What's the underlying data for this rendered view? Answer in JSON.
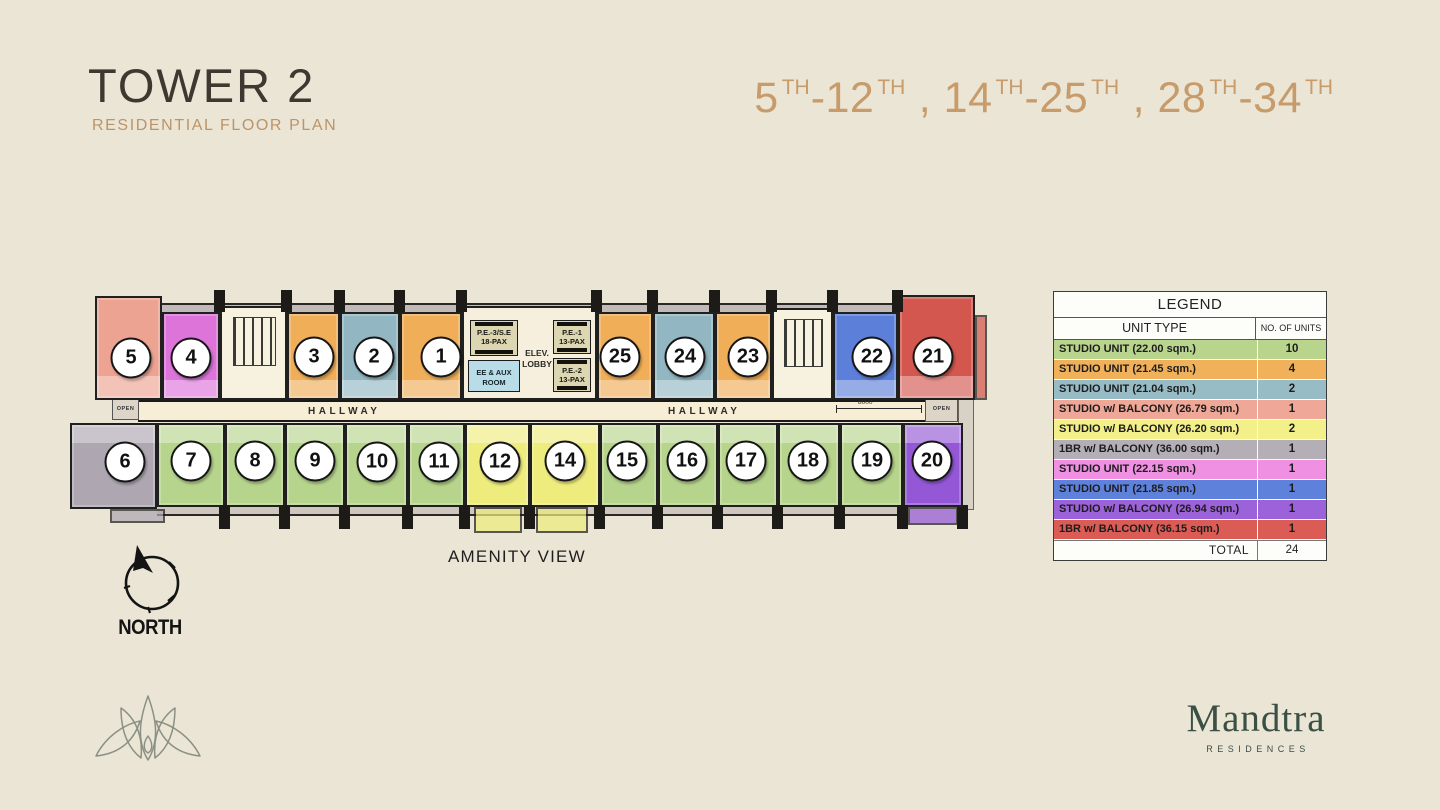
{
  "header": {
    "title": "TOWER 2",
    "subtitle": "RESIDENTIAL FLOOR PLAN",
    "floors": [
      {
        "base": "5",
        "sup": "TH"
      },
      {
        "base": "-12",
        "sup": "TH"
      },
      {
        "base": " , 14",
        "sup": "TH"
      },
      {
        "base": "-25",
        "sup": "TH"
      },
      {
        "base": " , 28",
        "sup": "TH"
      },
      {
        "base": "-34",
        "sup": "TH"
      }
    ]
  },
  "plan": {
    "hallway_label": "HALLWAY",
    "amenity_label": "AMENITY VIEW",
    "north_label": "NORTH",
    "open_label": "OPEN",
    "dimension": "8000",
    "core": {
      "pe3_l1": "P.E.-3/S.E",
      "pe3_l2": "18-PAX",
      "pe1_l1": "P.E.-1",
      "pe1_l2": "13-PAX",
      "pe2_l1": "P.E.-2",
      "pe2_l2": "13-PAX",
      "ee_l1": "EE & AUX",
      "ee_l2": "ROOM",
      "lobby_l1": "ELEV.",
      "lobby_l2": "LOBBY"
    },
    "units": [
      {
        "no": "5",
        "row": "top",
        "x": 95,
        "y": 296,
        "w": 67,
        "h": 104,
        "cx": 131,
        "cy": 358,
        "color": "#eda392"
      },
      {
        "no": "4",
        "row": "top",
        "x": 162,
        "y": 312,
        "w": 58,
        "h": 88,
        "cx": 191,
        "cy": 358,
        "color": "#dd74da"
      },
      {
        "no": "3",
        "row": "top",
        "x": 287,
        "y": 312,
        "w": 53,
        "h": 88,
        "cx": 314,
        "cy": 357,
        "color": "#f0ae58"
      },
      {
        "no": "2",
        "row": "top",
        "x": 340,
        "y": 312,
        "w": 60,
        "h": 88,
        "cx": 374,
        "cy": 357,
        "color": "#92b7c2"
      },
      {
        "no": "1",
        "row": "top",
        "x": 400,
        "y": 312,
        "w": 62,
        "h": 88,
        "cx": 441,
        "cy": 357,
        "color": "#f0ae58"
      },
      {
        "no": "25",
        "row": "top",
        "x": 597,
        "y": 312,
        "w": 56,
        "h": 88,
        "cx": 620,
        "cy": 357,
        "color": "#f0ae58"
      },
      {
        "no": "24",
        "row": "top",
        "x": 653,
        "y": 312,
        "w": 62,
        "h": 88,
        "cx": 685,
        "cy": 357,
        "color": "#92b7c2"
      },
      {
        "no": "23",
        "row": "top",
        "x": 715,
        "y": 312,
        "w": 57,
        "h": 88,
        "cx": 748,
        "cy": 357,
        "color": "#f0ae58"
      },
      {
        "no": "22",
        "row": "top",
        "x": 833,
        "y": 312,
        "w": 65,
        "h": 88,
        "cx": 872,
        "cy": 357,
        "color": "#5c80da"
      },
      {
        "no": "21",
        "row": "top",
        "x": 898,
        "y": 295,
        "w": 77,
        "h": 105,
        "cx": 933,
        "cy": 357,
        "color": "#d4574f",
        "balcony": {
          "x": 975,
          "y": 315,
          "w": 12,
          "h": 85
        }
      },
      {
        "no": "6",
        "row": "bot",
        "x": 70,
        "y": 423,
        "w": 87,
        "h": 86,
        "cx": 125,
        "cy": 462,
        "color": "#aea7b2",
        "balcony": {
          "x": 110,
          "y": 509,
          "w": 55,
          "h": 14
        }
      },
      {
        "no": "7",
        "row": "bot",
        "x": 157,
        "y": 423,
        "w": 68,
        "h": 84,
        "cx": 191,
        "cy": 461,
        "color": "#b6d48c"
      },
      {
        "no": "8",
        "row": "bot",
        "x": 225,
        "y": 423,
        "w": 60,
        "h": 84,
        "cx": 255,
        "cy": 461,
        "color": "#b6d48c"
      },
      {
        "no": "9",
        "row": "bot",
        "x": 285,
        "y": 423,
        "w": 60,
        "h": 84,
        "cx": 315,
        "cy": 461,
        "color": "#b6d48c"
      },
      {
        "no": "10",
        "row": "bot",
        "x": 345,
        "y": 423,
        "w": 63,
        "h": 84,
        "cx": 377,
        "cy": 462,
        "color": "#b6d48c"
      },
      {
        "no": "11",
        "row": "bot",
        "x": 408,
        "y": 423,
        "w": 57,
        "h": 84,
        "cx": 439,
        "cy": 462,
        "color": "#b6d48c"
      },
      {
        "no": "12",
        "row": "bot",
        "x": 465,
        "y": 423,
        "w": 65,
        "h": 84,
        "cx": 500,
        "cy": 462,
        "color": "#efec7e",
        "balcony": {
          "x": 474,
          "y": 507,
          "w": 48,
          "h": 26
        }
      },
      {
        "no": "14",
        "row": "bot",
        "x": 530,
        "y": 423,
        "w": 70,
        "h": 84,
        "cx": 565,
        "cy": 461,
        "color": "#efec7e",
        "balcony": {
          "x": 536,
          "y": 507,
          "w": 52,
          "h": 26
        }
      },
      {
        "no": "15",
        "row": "bot",
        "x": 600,
        "y": 423,
        "w": 58,
        "h": 84,
        "cx": 627,
        "cy": 461,
        "color": "#b6d48c"
      },
      {
        "no": "16",
        "row": "bot",
        "x": 658,
        "y": 423,
        "w": 60,
        "h": 84,
        "cx": 687,
        "cy": 461,
        "color": "#b6d48c"
      },
      {
        "no": "17",
        "row": "bot",
        "x": 718,
        "y": 423,
        "w": 60,
        "h": 84,
        "cx": 746,
        "cy": 461,
        "color": "#b6d48c"
      },
      {
        "no": "18",
        "row": "bot",
        "x": 778,
        "y": 423,
        "w": 62,
        "h": 84,
        "cx": 808,
        "cy": 461,
        "color": "#b6d48c"
      },
      {
        "no": "19",
        "row": "bot",
        "x": 840,
        "y": 423,
        "w": 63,
        "h": 84,
        "cx": 872,
        "cy": 461,
        "color": "#b6d48c"
      },
      {
        "no": "20",
        "row": "bot",
        "x": 903,
        "y": 423,
        "w": 60,
        "h": 84,
        "cx": 932,
        "cy": 461,
        "color": "#9458d6",
        "balcony": {
          "x": 908,
          "y": 507,
          "w": 50,
          "h": 18
        }
      }
    ]
  },
  "legend": {
    "title": "LEGEND",
    "col1": "UNIT TYPE",
    "col2": "NO. OF UNITS",
    "rows": [
      {
        "label": "STUDIO UNIT (22.00 sqm.)",
        "count": "10",
        "color": "#b9d58d"
      },
      {
        "label": "STUDIO UNIT (21.45 sqm.)",
        "count": "4",
        "color": "#f1b15b"
      },
      {
        "label": "STUDIO UNIT (21.04 sqm.)",
        "count": "2",
        "color": "#97bcc6"
      },
      {
        "label": "STUDIO w/ BALCONY (26.79 sqm.)",
        "count": "1",
        "color": "#efa797"
      },
      {
        "label": "STUDIO w/ BALCONY (26.20 sqm.)",
        "count": "2",
        "color": "#f3f08a"
      },
      {
        "label": "1BR w/ BALCONY (36.00 sqm.)",
        "count": "1",
        "color": "#b4aeb7"
      },
      {
        "label": "STUDIO UNIT (22.15 sqm.)",
        "count": "1",
        "color": "#ef90e2"
      },
      {
        "label": "STUDIO UNIT (21.85 sqm.)",
        "count": "1",
        "color": "#5e82dc"
      },
      {
        "label": "STUDIO w/ BALCONY (26.94 sqm.)",
        "count": "1",
        "color": "#9c62da"
      },
      {
        "label": "1BR w/ BALCONY (36.15 sqm.)",
        "count": "1",
        "color": "#da5c55"
      }
    ],
    "total_label": "TOTAL",
    "total": "24"
  },
  "footer": {
    "brand": "Mandtra",
    "brand_sub": "RESIDENCES"
  }
}
